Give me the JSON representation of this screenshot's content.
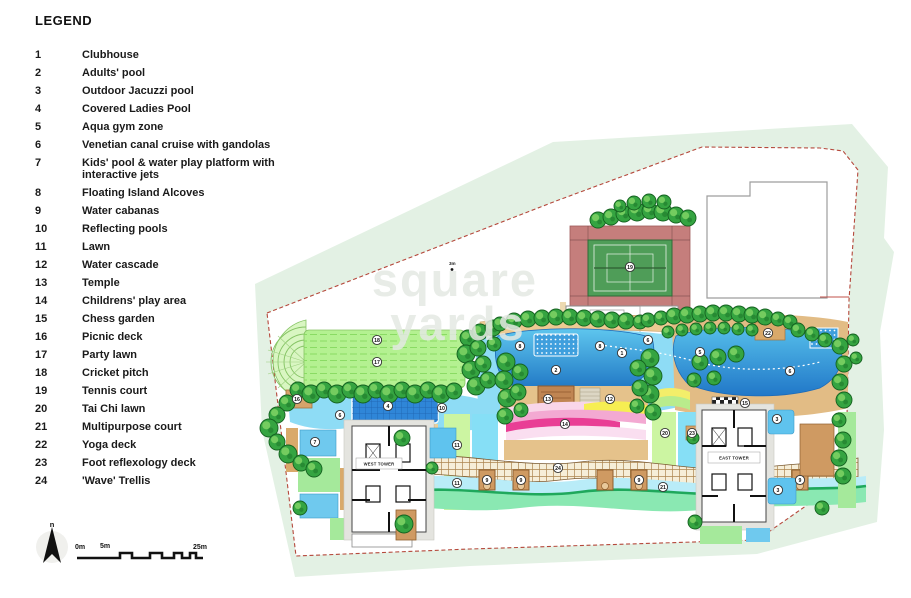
{
  "legend": {
    "title": "LEGEND",
    "items": [
      {
        "num": "1",
        "label": "Clubhouse"
      },
      {
        "num": "2",
        "label": "Adults' pool"
      },
      {
        "num": "3",
        "label": "Outdoor Jacuzzi pool"
      },
      {
        "num": "4",
        "label": "Covered Ladies Pool"
      },
      {
        "num": "5",
        "label": "Aqua gym zone"
      },
      {
        "num": "6",
        "label": "Venetian canal cruise with gandolas"
      },
      {
        "num": "7",
        "label": "Kids' pool & water play platform with interactive jets"
      },
      {
        "num": "8",
        "label": "Floating Island Alcoves"
      },
      {
        "num": "9",
        "label": "Water cabanas"
      },
      {
        "num": "10",
        "label": "Reflecting pools"
      },
      {
        "num": "11",
        "label": "Lawn"
      },
      {
        "num": "12",
        "label": "Water cascade"
      },
      {
        "num": "13",
        "label": "Temple"
      },
      {
        "num": "14",
        "label": "Childrens' play area"
      },
      {
        "num": "15",
        "label": "Chess garden"
      },
      {
        "num": "16",
        "label": "Picnic deck"
      },
      {
        "num": "17",
        "label": "Party lawn"
      },
      {
        "num": "18",
        "label": "Cricket pitch"
      },
      {
        "num": "19",
        "label": "Tennis court"
      },
      {
        "num": "20",
        "label": "Tai Chi lawn"
      },
      {
        "num": "21",
        "label": "Multipurpose court"
      },
      {
        "num": "22",
        "label": "Yoga deck"
      },
      {
        "num": "23",
        "label": "Foot reflexology deck"
      },
      {
        "num": "24",
        "label": "'Wave' Trellis"
      }
    ]
  },
  "plan": {
    "west_tower_label": "WEST TOWER",
    "east_tower_label": "EAST TOWER",
    "watermark_line1": "square",
    "watermark_line2": "yards",
    "annotation": "3m",
    "markers": [
      {
        "n": "19",
        "x": 630,
        "y": 267
      },
      {
        "n": "1",
        "x": 622,
        "y": 353
      },
      {
        "n": "18",
        "x": 377,
        "y": 340
      },
      {
        "n": "17",
        "x": 377,
        "y": 362
      },
      {
        "n": "16",
        "x": 297,
        "y": 399
      },
      {
        "n": "4",
        "x": 388,
        "y": 406
      },
      {
        "n": "6",
        "x": 340,
        "y": 415
      },
      {
        "n": "7",
        "x": 315,
        "y": 442
      },
      {
        "n": "10",
        "x": 442,
        "y": 408
      },
      {
        "n": "11",
        "x": 457,
        "y": 445
      },
      {
        "n": "11",
        "x": 457,
        "y": 483
      },
      {
        "n": "8",
        "x": 520,
        "y": 346
      },
      {
        "n": "8",
        "x": 600,
        "y": 346
      },
      {
        "n": "2",
        "x": 556,
        "y": 370
      },
      {
        "n": "13",
        "x": 548,
        "y": 399
      },
      {
        "n": "12",
        "x": 610,
        "y": 399
      },
      {
        "n": "14",
        "x": 565,
        "y": 424
      },
      {
        "n": "6",
        "x": 648,
        "y": 340
      },
      {
        "n": "5",
        "x": 700,
        "y": 352
      },
      {
        "n": "6",
        "x": 790,
        "y": 371
      },
      {
        "n": "22",
        "x": 768,
        "y": 333
      },
      {
        "n": "15",
        "x": 745,
        "y": 403
      },
      {
        "n": "20",
        "x": 665,
        "y": 433
      },
      {
        "n": "23",
        "x": 692,
        "y": 433
      },
      {
        "n": "21",
        "x": 663,
        "y": 487
      },
      {
        "n": "3",
        "x": 777,
        "y": 419
      },
      {
        "n": "3",
        "x": 778,
        "y": 490
      },
      {
        "n": "24",
        "x": 558,
        "y": 468
      },
      {
        "n": "9",
        "x": 487,
        "y": 480
      },
      {
        "n": "9",
        "x": 521,
        "y": 480
      },
      {
        "n": "9",
        "x": 639,
        "y": 480
      },
      {
        "n": "9",
        "x": 800,
        "y": 480
      }
    ],
    "colors": {
      "boundary_dash": "#b5483b",
      "mint_background": "#e3f1e4",
      "lawn_green": "#b4f191",
      "pool_blue": "#2f86d8",
      "canal_blue": "#8edcf5",
      "tennis_pad": "#c57e7c",
      "court_green": "#4f9d58",
      "deck_tan": "#e5c28b",
      "tree_green": "#35a441",
      "play_magenta": "#e93e95",
      "play_yellow": "#f6ee52",
      "wave_green": "#8ae8b2"
    }
  },
  "map_controls": {
    "north_label": "n",
    "scale_labels": [
      "0m",
      "5m",
      "25m"
    ]
  }
}
